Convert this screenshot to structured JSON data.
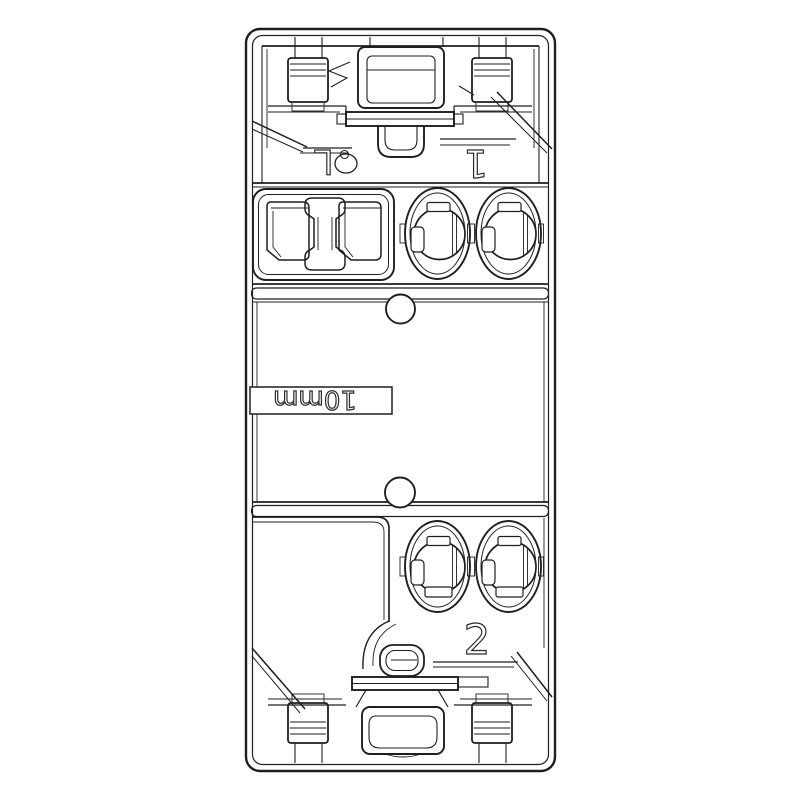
{
  "page": {
    "background": "#ffffff"
  },
  "drawing": {
    "kind": "technical-line-drawing",
    "line_color": "#1f1f1f",
    "labels": {
      "load": "L",
      "terminal_1": "1",
      "terminal_2": "2",
      "strip_gauge": "10mm"
    }
  }
}
